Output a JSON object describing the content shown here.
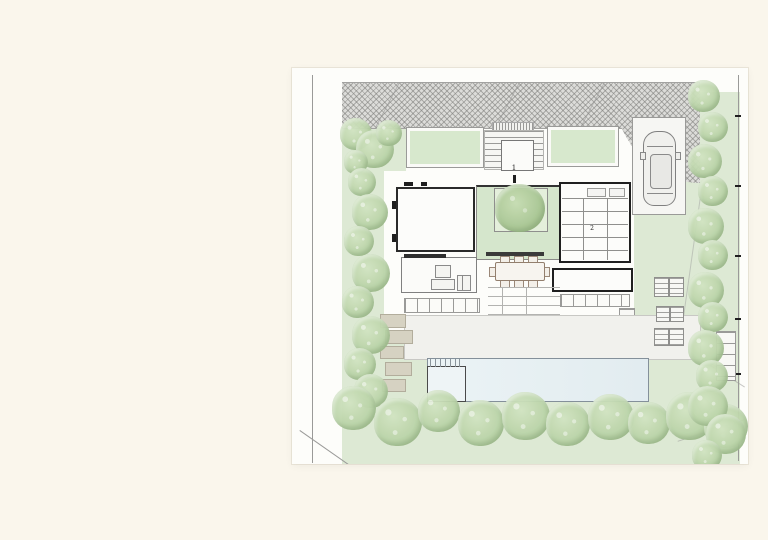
{
  "scene": {
    "background_color": "#faf6ec",
    "description": "Architectural landscape site plan of a villa with pool, drawn on a white sheet over a cream backdrop"
  },
  "plan": {
    "labels": {
      "entry_marker": "1",
      "roof_room_marker": "2"
    },
    "colors": {
      "paper": "#fdfdfa",
      "street_paving": "#dcdcd9",
      "lawn": "#dde9d4",
      "planter_green": "#d7e8cd",
      "courtyard_green": "#d5e6cc",
      "tree_green": "#bcd5ab",
      "pool_water": "#e6eff2",
      "terrace": "#f1f1ed",
      "wall_dark": "#222222",
      "line_gray": "#9a9a98",
      "paver_beige": "#d6d2c2"
    },
    "elements": [
      "hatched street paving",
      "entry stair with landing",
      "green roof planters",
      "parking stall with car",
      "main room",
      "planted courtyard with tree",
      "gridded roof room",
      "living room with sofas",
      "dining table with chairs",
      "terrace",
      "swimming pool with shallow corner",
      "sun loungers",
      "stepping stones",
      "perimeter trees and lawn",
      "site boundary lines"
    ]
  }
}
